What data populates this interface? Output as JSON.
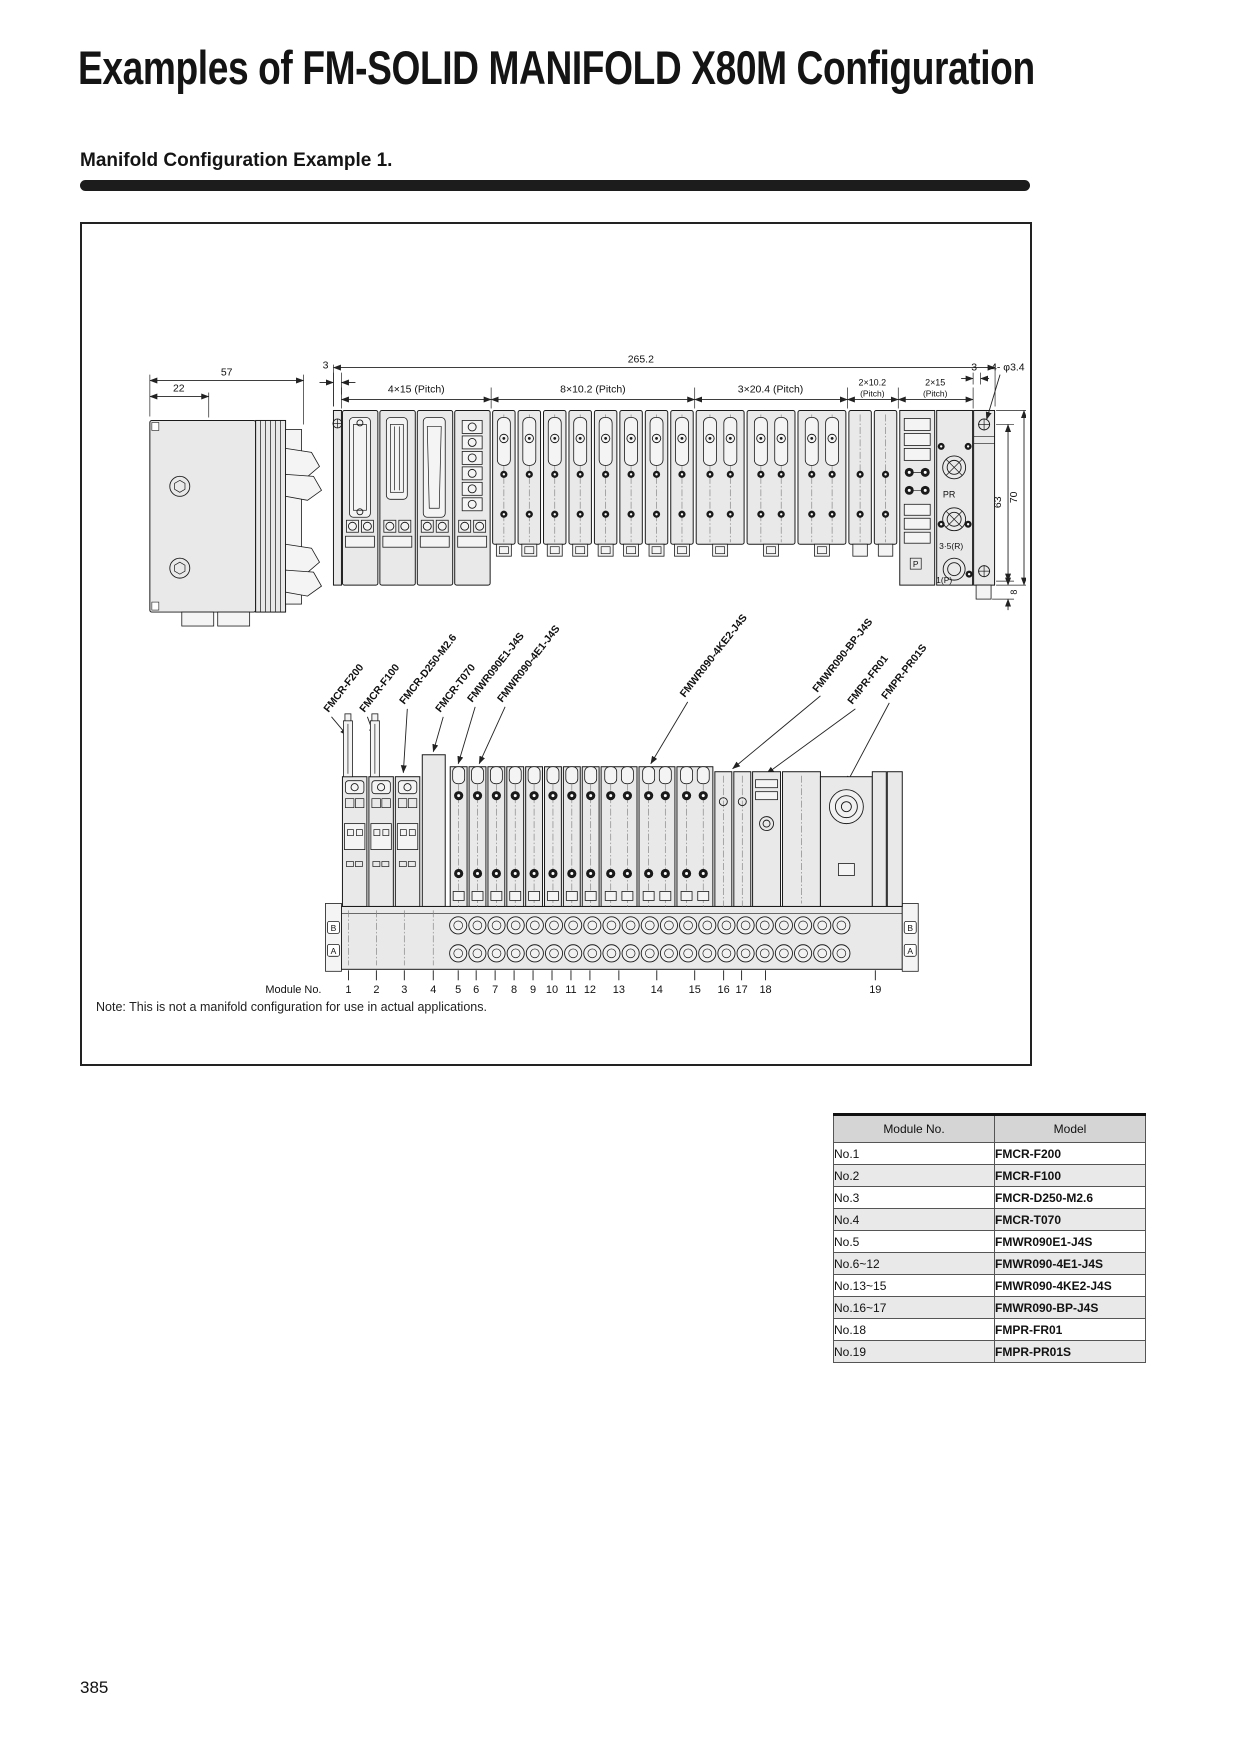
{
  "page": {
    "title": "Examples of FM-SOLID MANIFOLD X80M Configuration",
    "section_heading": "Manifold Configuration Example 1.",
    "note": "Note: This is not a manifold configuration for use in actual applications.",
    "page_number": "385"
  },
  "top_view": {
    "dims": {
      "side_width": "57",
      "side_sub": "22",
      "offset_left": "3",
      "overall": "265.2",
      "pitch1": "4×15 (Pitch)",
      "pitch2": "8×10.2 (Pitch)",
      "pitch3": "3×20.4 (Pitch)",
      "pitch4a": "2×10.2",
      "pitch4b": "(Pitch)",
      "pitch5a": "2×15",
      "pitch5b": "(Pitch)",
      "offset_right": "3",
      "holes": "4- φ3.4",
      "height1": "63",
      "height2": "70",
      "foot": "8"
    },
    "ports": {
      "pr": "PR",
      "r": "3·5(R)",
      "p": "1(P)",
      "p_symbol": "P"
    }
  },
  "bottom_view": {
    "module_no_label": "Module No.",
    "module_numbers": [
      "1",
      "2",
      "3",
      "4",
      "5",
      "6",
      "7",
      "8",
      "9",
      "10",
      "11",
      "12",
      "13",
      "14",
      "15",
      "16",
      "17",
      "18",
      "19"
    ],
    "part_labels": [
      "FMCR-F200",
      "FMCR-F100",
      "FMCR-D250-M2.6",
      "FMCR-T070",
      "FMWR090E1-J4S",
      "FMWR090-4E1-J4S",
      "FMWR090-4KE2-J4S",
      "FMWR090-BP-J4S",
      "FMPR-FR01",
      "FMPR-PR01S"
    ],
    "end_markers": {
      "b": "B",
      "a": "A"
    }
  },
  "table": {
    "headers": [
      "Module No.",
      "Model"
    ],
    "rows": [
      {
        "module": "No.1",
        "model": "FMCR-F200"
      },
      {
        "module": "No.2",
        "model": "FMCR-F100"
      },
      {
        "module": "No.3",
        "model": "FMCR-D250-M2.6"
      },
      {
        "module": "No.4",
        "model": "FMCR-T070"
      },
      {
        "module": "No.5",
        "model": "FMWR090E1-J4S"
      },
      {
        "module": "No.6~12",
        "model": "FMWR090-4E1-J4S"
      },
      {
        "module": "No.13~15",
        "model": "FMWR090-4KE2-J4S"
      },
      {
        "module": "No.16~17",
        "model": "FMWR090-BP-J4S"
      },
      {
        "module": "No.18",
        "model": "FMPR-FR01"
      },
      {
        "module": "No.19",
        "model": "FMPR-PR01S"
      }
    ]
  }
}
